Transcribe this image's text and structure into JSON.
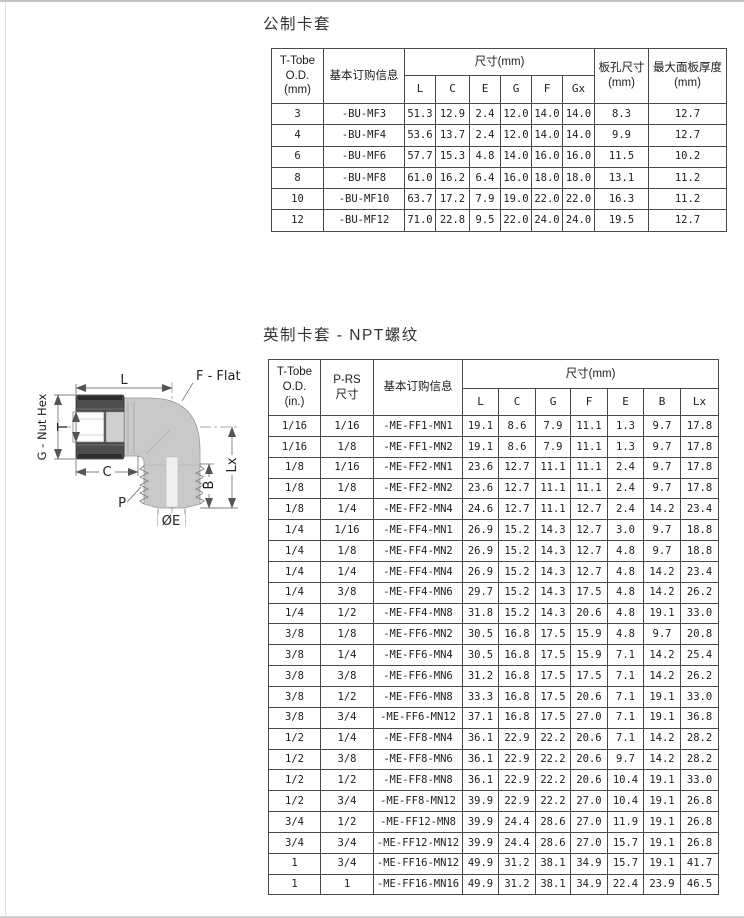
{
  "sections": {
    "metric": {
      "title": "公制卡套",
      "header": {
        "tube_od": "T-Tobe\nO.D.\n(mm)",
        "ordering": "基本订购信息",
        "dims_group": "尺寸(mm)",
        "dim_cols": [
          "L",
          "C",
          "E",
          "G",
          "F",
          "Gx"
        ],
        "panel_hole": "板孔尺寸\n(mm)",
        "max_panel": "最大面板厚度\n(mm)"
      },
      "rows": [
        [
          "3",
          "-BU-MF3",
          "51.3",
          "12.9",
          "2.4",
          "12.0",
          "14.0",
          "14.0",
          "8.3",
          "12.7"
        ],
        [
          "4",
          "-BU-MF4",
          "53.6",
          "13.7",
          "2.4",
          "12.0",
          "14.0",
          "14.0",
          "9.9",
          "12.7"
        ],
        [
          "6",
          "-BU-MF6",
          "57.7",
          "15.3",
          "4.8",
          "14.0",
          "16.0",
          "16.0",
          "11.5",
          "10.2"
        ],
        [
          "8",
          "-BU-MF8",
          "61.0",
          "16.2",
          "6.4",
          "16.0",
          "18.0",
          "18.0",
          "13.1",
          "11.2"
        ],
        [
          "10",
          "-BU-MF10",
          "63.7",
          "17.2",
          "7.9",
          "19.0",
          "22.0",
          "22.0",
          "16.3",
          "11.2"
        ],
        [
          "12",
          "-BU-MF12",
          "71.0",
          "22.8",
          "9.5",
          "22.0",
          "24.0",
          "24.0",
          "19.5",
          "12.7"
        ]
      ]
    },
    "imperial": {
      "title": "英制卡套 - NPT螺纹",
      "header": {
        "tube_od": "T-Tobe\nO.D.\n(in.)",
        "p_rs": "P-RS\n尺寸",
        "ordering": "基本订购信息",
        "dims_group": "尺寸(mm)",
        "dim_cols": [
          "L",
          "C",
          "G",
          "F",
          "E",
          "B",
          "Lx"
        ]
      },
      "rows": [
        [
          "1/16",
          "1/16",
          "-ME-FF1-MN1",
          "19.1",
          "8.6",
          "7.9",
          "11.1",
          "1.3",
          "9.7",
          "17.8"
        ],
        [
          "1/16",
          "1/8",
          "-ME-FF1-MN2",
          "19.1",
          "8.6",
          "7.9",
          "11.1",
          "1.3",
          "9.7",
          "17.8"
        ],
        [
          "1/8",
          "1/16",
          "-ME-FF2-MN1",
          "23.6",
          "12.7",
          "11.1",
          "11.1",
          "2.4",
          "9.7",
          "17.8"
        ],
        [
          "1/8",
          "1/8",
          "-ME-FF2-MN2",
          "23.6",
          "12.7",
          "11.1",
          "11.1",
          "2.4",
          "9.7",
          "17.8"
        ],
        [
          "1/8",
          "1/4",
          "-ME-FF2-MN4",
          "24.6",
          "12.7",
          "11.1",
          "12.7",
          "2.4",
          "14.2",
          "23.4"
        ],
        [
          "1/4",
          "1/16",
          "-ME-FF4-MN1",
          "26.9",
          "15.2",
          "14.3",
          "12.7",
          "3.0",
          "9.7",
          "18.8"
        ],
        [
          "1/4",
          "1/8",
          "-ME-FF4-MN2",
          "26.9",
          "15.2",
          "14.3",
          "12.7",
          "4.8",
          "9.7",
          "18.8"
        ],
        [
          "1/4",
          "1/4",
          "-ME-FF4-MN4",
          "26.9",
          "15.2",
          "14.3",
          "12.7",
          "4.8",
          "14.2",
          "23.4"
        ],
        [
          "1/4",
          "3/8",
          "-ME-FF4-MN6",
          "29.7",
          "15.2",
          "14.3",
          "17.5",
          "4.8",
          "14.2",
          "26.2"
        ],
        [
          "1/4",
          "1/2",
          "-ME-FF4-MN8",
          "31.8",
          "15.2",
          "14.3",
          "20.6",
          "4.8",
          "19.1",
          "33.0"
        ],
        [
          "3/8",
          "1/8",
          "-ME-FF6-MN2",
          "30.5",
          "16.8",
          "17.5",
          "15.9",
          "4.8",
          "9.7",
          "20.8"
        ],
        [
          "3/8",
          "1/4",
          "-ME-FF6-MN4",
          "30.5",
          "16.8",
          "17.5",
          "15.9",
          "7.1",
          "14.2",
          "25.4"
        ],
        [
          "3/8",
          "3/8",
          "-ME-FF6-MN6",
          "31.2",
          "16.8",
          "17.5",
          "17.5",
          "7.1",
          "14.2",
          "26.2"
        ],
        [
          "3/8",
          "1/2",
          "-ME-FF6-MN8",
          "33.3",
          "16.8",
          "17.5",
          "20.6",
          "7.1",
          "19.1",
          "33.0"
        ],
        [
          "3/8",
          "3/4",
          "-ME-FF6-MN12",
          "37.1",
          "16.8",
          "17.5",
          "27.0",
          "7.1",
          "19.1",
          "36.8"
        ],
        [
          "1/2",
          "1/4",
          "-ME-FF8-MN4",
          "36.1",
          "22.9",
          "22.2",
          "20.6",
          "7.1",
          "14.2",
          "28.2"
        ],
        [
          "1/2",
          "3/8",
          "-ME-FF8-MN6",
          "36.1",
          "22.9",
          "22.2",
          "20.6",
          "9.7",
          "14.2",
          "28.2"
        ],
        [
          "1/2",
          "1/2",
          "-ME-FF8-MN8",
          "36.1",
          "22.9",
          "22.2",
          "20.6",
          "10.4",
          "19.1",
          "33.0"
        ],
        [
          "1/2",
          "3/4",
          "-ME-FF8-MN12",
          "39.9",
          "22.9",
          "22.2",
          "27.0",
          "10.4",
          "19.1",
          "26.8"
        ],
        [
          "3/4",
          "1/2",
          "-ME-FF12-MN8",
          "39.9",
          "24.4",
          "28.6",
          "27.0",
          "11.9",
          "19.1",
          "26.8"
        ],
        [
          "3/4",
          "3/4",
          "-ME-FF12-MN12",
          "39.9",
          "24.4",
          "28.6",
          "27.0",
          "15.7",
          "19.1",
          "26.8"
        ],
        [
          "1",
          "3/4",
          "-ME-FF16-MN12",
          "49.9",
          "31.2",
          "38.1",
          "34.9",
          "15.7",
          "19.1",
          "41.7"
        ],
        [
          "1",
          "1",
          "-ME-FF16-MN16",
          "49.9",
          "31.2",
          "38.1",
          "34.9",
          "22.4",
          "23.9",
          "46.5"
        ]
      ]
    }
  },
  "diagram": {
    "labels": {
      "l": "L",
      "f_flat": "F - Flat",
      "g_nut_hex": "G - Nut Hex",
      "t": "T",
      "c": "C",
      "p": "P",
      "oe": "ØE",
      "b": "B",
      "lx": "Lx"
    },
    "colors": {
      "body_gray": "#c9c9c9",
      "nut_dark": "#4e4e4e",
      "line": "#555555"
    }
  }
}
